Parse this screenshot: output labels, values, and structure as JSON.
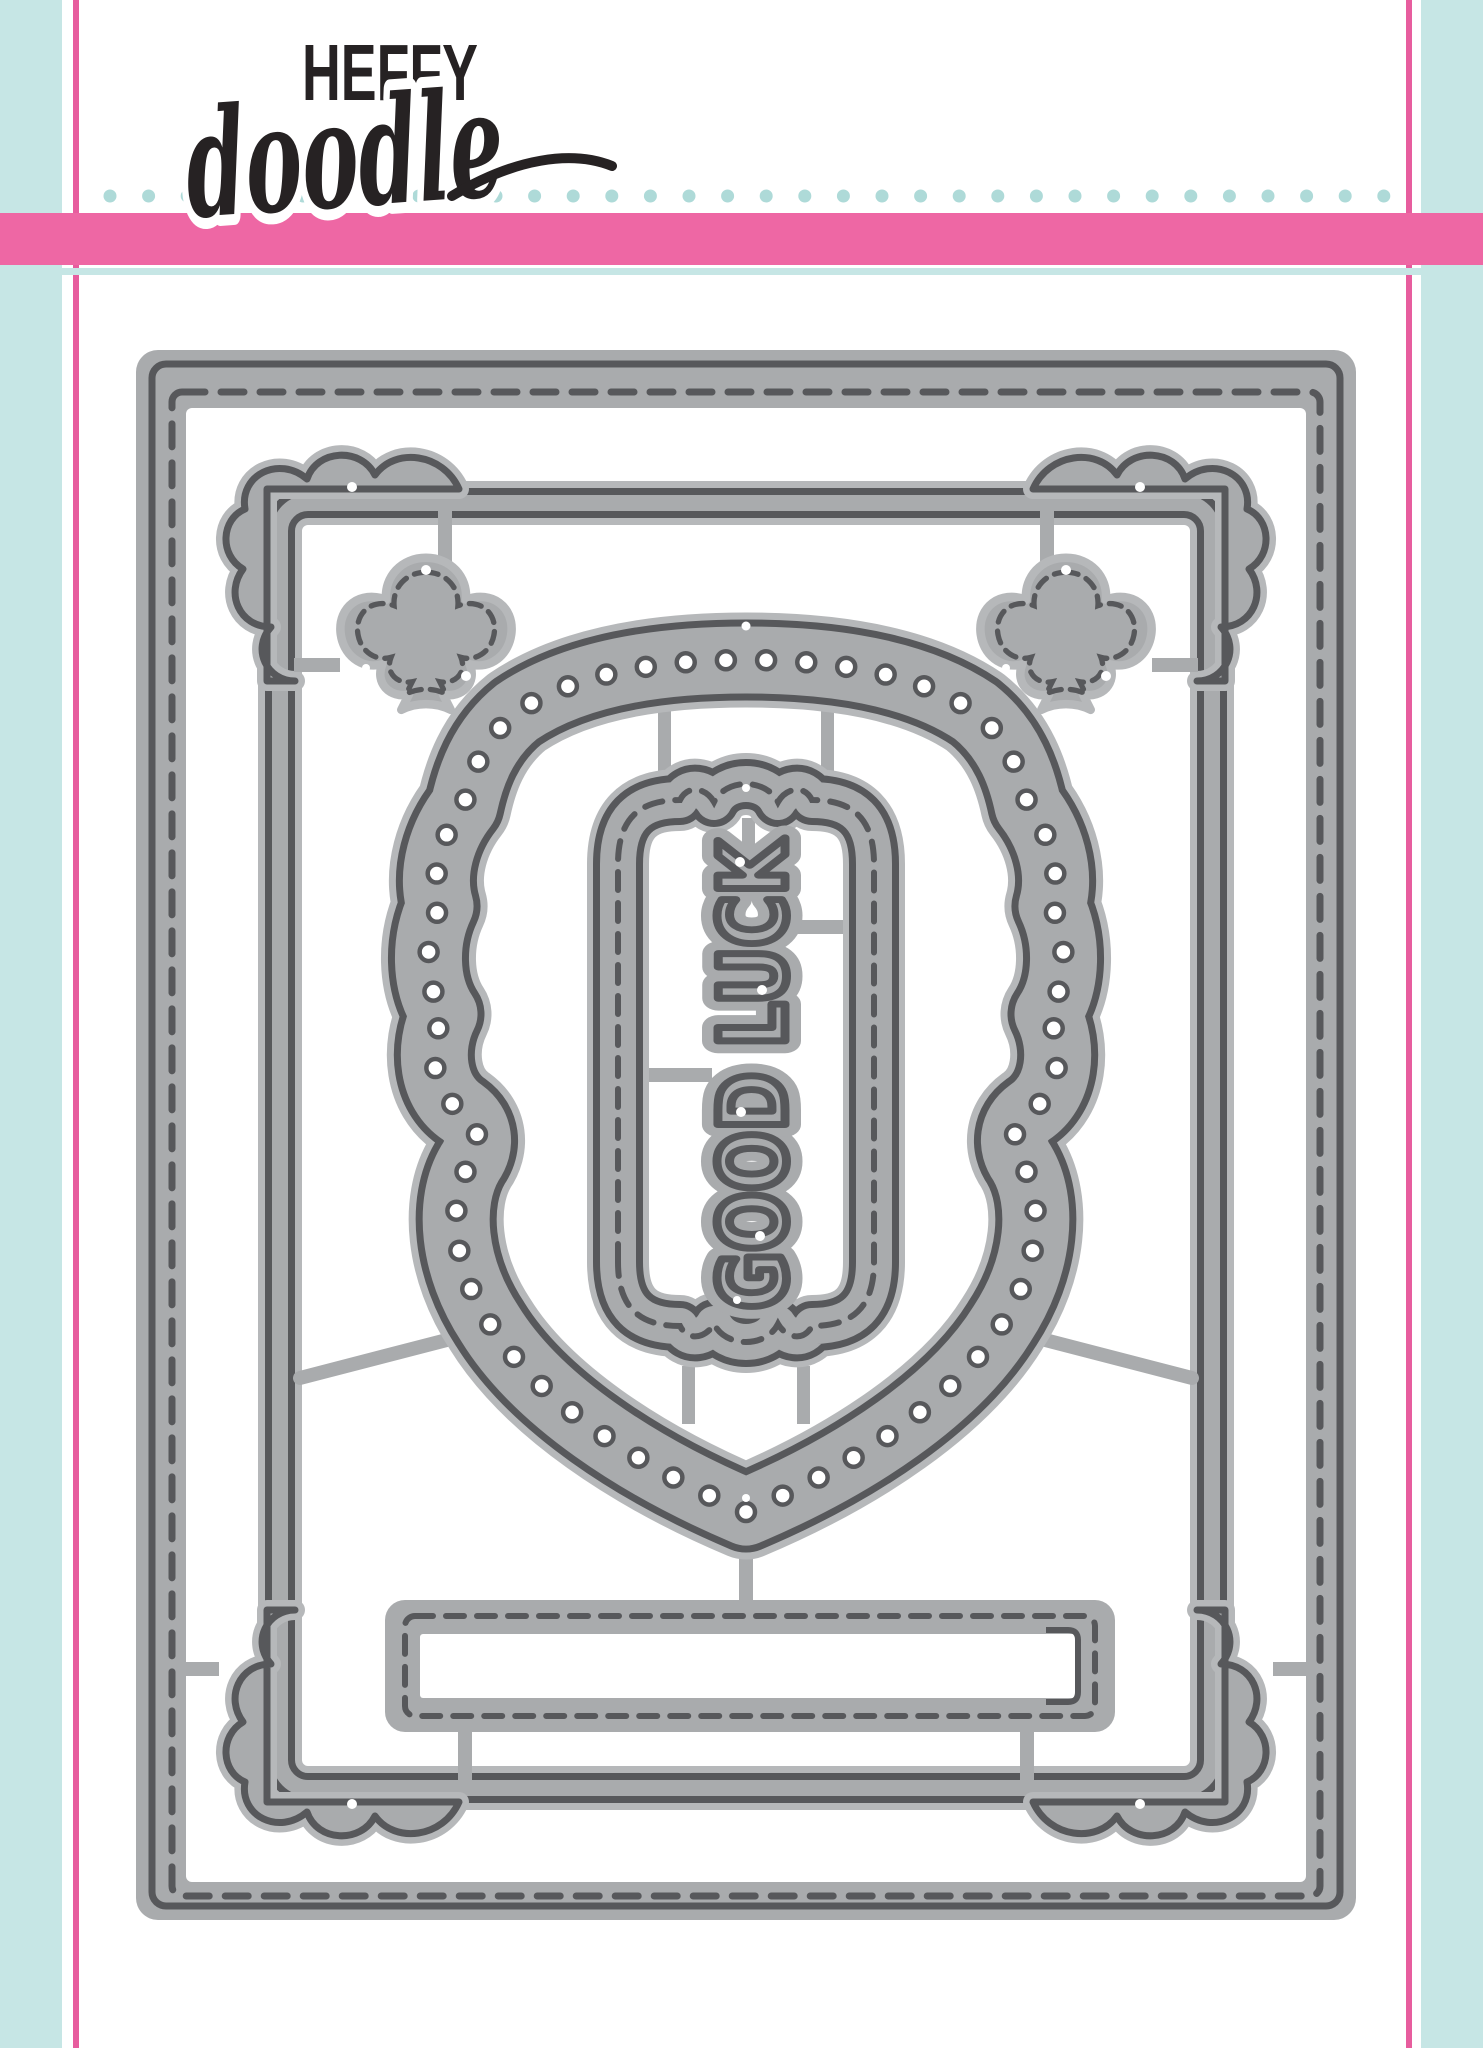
{
  "brand": {
    "name_line1": "HEFFY",
    "name_line2": "doodle"
  },
  "die": {
    "sentiment": "GOOD LUCK"
  },
  "colors": {
    "teal_stripe": "#c6e6e5",
    "teal_dot": "#aedad8",
    "pink_stripe": "#ee67a4",
    "pink_line": "#e75d9e",
    "die_fill": "#a9abad",
    "die_casing": "#b6b8ba",
    "die_outline": "#57585b",
    "ink": "#262223",
    "paper": "#ffffff"
  }
}
